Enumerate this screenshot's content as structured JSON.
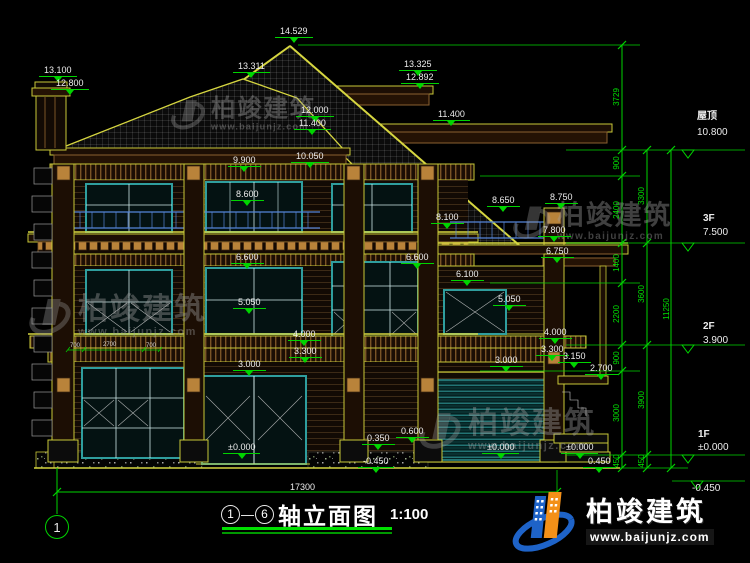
{
  "drawing": {
    "title_axis_start": "1",
    "title_axis_end": "6",
    "axis_separator": "—",
    "title_text": "轴立面图",
    "title_scale": "1:100",
    "axis_bubble": "1",
    "overall_width_dim": "17300"
  },
  "watermark": {
    "brand": "柏竣建筑",
    "url": "www.baijunjz.com"
  },
  "logo": {
    "brand": "柏竣建筑",
    "url": "www.baijunjz.com"
  },
  "colors": {
    "dim_green": "#00d400",
    "cad_yellow": "#c8c838",
    "window_teal": "#2f9e9e",
    "rail_blue": "#5585d8",
    "ornament_tan": "#b9833a",
    "logo_blue": "#1e63c8",
    "logo_orange": "#f39018"
  },
  "levels_panel": [
    {
      "label": "屋顶",
      "value": "10.800",
      "x": 697,
      "label_y": 112,
      "value_y": 128
    },
    {
      "label": "3F",
      "value": "7.500",
      "x": 703,
      "label_y": 214,
      "value_y": 228
    },
    {
      "label": "2F",
      "value": "3.900",
      "x": 703,
      "label_y": 322,
      "value_y": 336
    },
    {
      "label": "1F",
      "value": "±0.000",
      "x": 698,
      "label_y": 430,
      "value_y": 443
    },
    {
      "label": "",
      "value": "-0.450",
      "x": 692,
      "label_y": 0,
      "value_y": 484
    }
  ],
  "elevation_marks": [
    {
      "t": "13.100",
      "x": 44,
      "y": 66
    },
    {
      "t": "12.800",
      "x": 56,
      "y": 79
    },
    {
      "t": "14.529",
      "x": 280,
      "y": 27
    },
    {
      "t": "13.311",
      "x": 238,
      "y": 62
    },
    {
      "t": "13.325",
      "x": 404,
      "y": 60
    },
    {
      "t": "12.892",
      "x": 406,
      "y": 73
    },
    {
      "t": "12.000",
      "x": 301,
      "y": 106
    },
    {
      "t": "11.400",
      "x": 299,
      "y": 119
    },
    {
      "t": "11.400",
      "x": 438,
      "y": 110
    },
    {
      "t": "10.050",
      "x": 296,
      "y": 152
    },
    {
      "t": "9.900",
      "x": 233,
      "y": 156
    },
    {
      "t": "8.600",
      "x": 236,
      "y": 190
    },
    {
      "t": "8.650",
      "x": 492,
      "y": 196
    },
    {
      "t": "8.750",
      "x": 550,
      "y": 193
    },
    {
      "t": "8.100",
      "x": 436,
      "y": 213
    },
    {
      "t": "7.800",
      "x": 543,
      "y": 226
    },
    {
      "t": "6.750",
      "x": 546,
      "y": 247
    },
    {
      "t": "6.600",
      "x": 236,
      "y": 253
    },
    {
      "t": "6.600",
      "x": 406,
      "y": 253
    },
    {
      "t": "6.100",
      "x": 456,
      "y": 270
    },
    {
      "t": "5.050",
      "x": 238,
      "y": 298
    },
    {
      "t": "5.050",
      "x": 498,
      "y": 295
    },
    {
      "t": "4.000",
      "x": 293,
      "y": 330
    },
    {
      "t": "4.000",
      "x": 544,
      "y": 328
    },
    {
      "t": "3.300",
      "x": 294,
      "y": 347
    },
    {
      "t": "3.300",
      "x": 541,
      "y": 345
    },
    {
      "t": "3.150",
      "x": 563,
      "y": 352
    },
    {
      "t": "3.000",
      "x": 238,
      "y": 360
    },
    {
      "t": "3.000",
      "x": 495,
      "y": 356
    },
    {
      "t": "2.700",
      "x": 590,
      "y": 364
    },
    {
      "t": "±0.000",
      "x": 228,
      "y": 443
    },
    {
      "t": "±0.000",
      "x": 487,
      "y": 443
    },
    {
      "t": "±0.000",
      "x": 566,
      "y": 443
    },
    {
      "t": "0.350",
      "x": 367,
      "y": 434
    },
    {
      "t": "0.600",
      "x": 401,
      "y": 427
    },
    {
      "t": "-0.450",
      "x": 363,
      "y": 457
    },
    {
      "t": "0.450",
      "x": 588,
      "y": 457
    }
  ],
  "chain_dims": [
    {
      "t": "3729",
      "x": 617,
      "y": 97
    },
    {
      "t": "900",
      "x": 617,
      "y": 163
    },
    {
      "t": "2400",
      "x": 617,
      "y": 210
    },
    {
      "t": "1400",
      "x": 617,
      "y": 263
    },
    {
      "t": "2200",
      "x": 617,
      "y": 314
    },
    {
      "t": "900",
      "x": 617,
      "y": 358
    },
    {
      "t": "3000",
      "x": 617,
      "y": 413
    },
    {
      "t": "450",
      "x": 617,
      "y": 461
    },
    {
      "t": "3300",
      "x": 642,
      "y": 196
    },
    {
      "t": "3600",
      "x": 642,
      "y": 294
    },
    {
      "t": "3900",
      "x": 642,
      "y": 400
    },
    {
      "t": "450",
      "x": 642,
      "y": 461
    },
    {
      "t": "11250",
      "x": 667,
      "y": 309
    }
  ],
  "inner_dims": [
    {
      "t": "700",
      "x": 70,
      "y": 343
    },
    {
      "t": "2700",
      "x": 103,
      "y": 342
    },
    {
      "t": "700",
      "x": 146,
      "y": 343
    }
  ]
}
